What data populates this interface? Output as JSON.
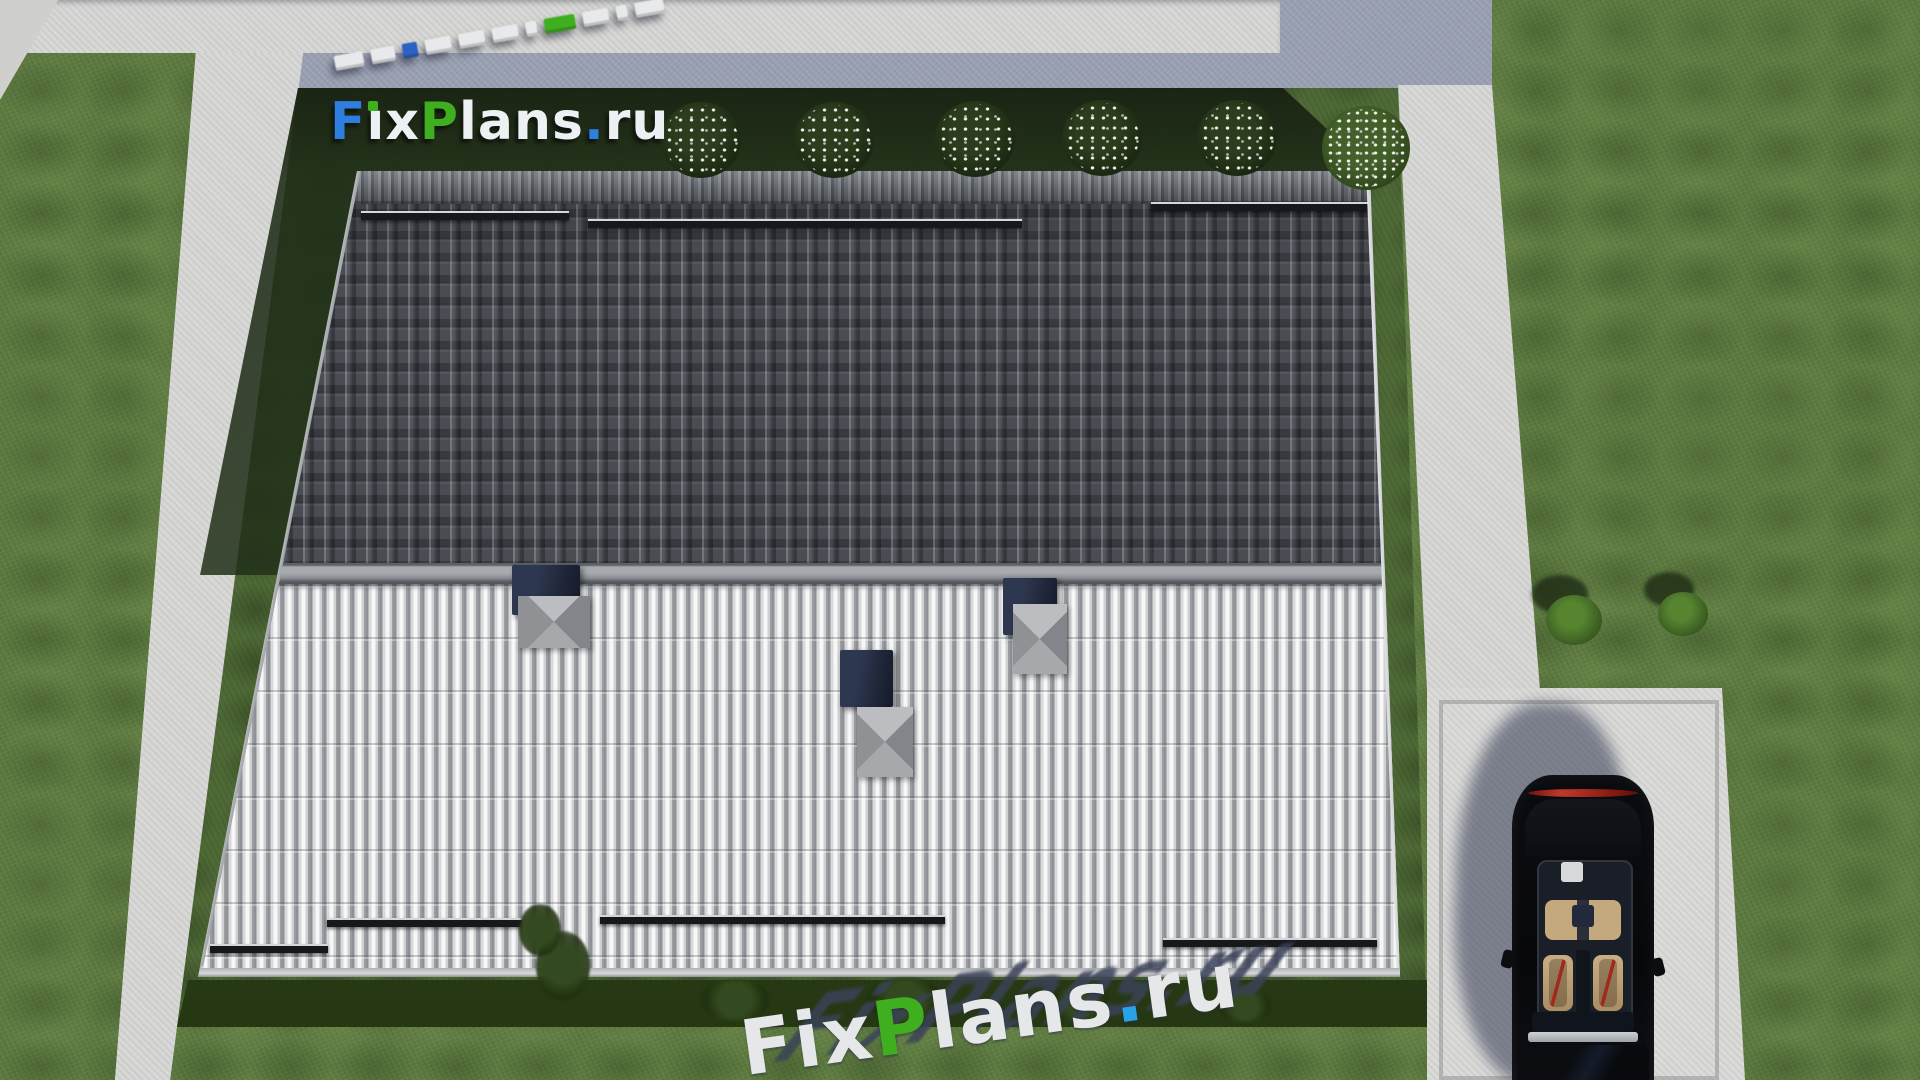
{
  "brand": {
    "name": "FixPlans.ru"
  },
  "logo": {
    "text": "FixPlans.ru",
    "letters": [
      {
        "ch": "F",
        "color": "#2e7ee0"
      },
      {
        "ch": "i",
        "color": "#eef1f3",
        "dot": "#3fae1f"
      },
      {
        "ch": "x",
        "color": "#eef1f3"
      },
      {
        "ch": "P",
        "color": "#3fae1f"
      },
      {
        "ch": "l",
        "color": "#eef1f3"
      },
      {
        "ch": "a",
        "color": "#eef1f3"
      },
      {
        "ch": "n",
        "color": "#eef1f3"
      },
      {
        "ch": "s",
        "color": "#eef1f3"
      },
      {
        "ch": ".",
        "color": "#2e7ee0"
      },
      {
        "ch": "r",
        "color": "#eef1f3"
      },
      {
        "ch": "u",
        "color": "#eef1f3"
      }
    ]
  },
  "watermark_top": {
    "text": "FixPlans.ru",
    "note": "3D extruded logo seen from above, reversed (reads right-to-left), ascending to the right",
    "blocks": [
      {
        "w": 29,
        "color": "w"
      },
      {
        "w": 24,
        "color": "w"
      },
      {
        "w": 15,
        "color": "b"
      },
      {
        "w": 26,
        "color": "w"
      },
      {
        "w": 26,
        "color": "w"
      },
      {
        "w": 26,
        "color": "w"
      },
      {
        "w": 11,
        "color": "w"
      },
      {
        "w": 31,
        "color": "g"
      },
      {
        "w": 26,
        "color": "w"
      },
      {
        "w": 11,
        "color": "w"
      },
      {
        "w": 29,
        "color": "w"
      }
    ]
  },
  "watermark_bottom": {
    "text": "FixPlans.ru",
    "letters": [
      {
        "ch": "F",
        "color": "#e6e7e9"
      },
      {
        "ch": "i",
        "color": "#e6e7e9"
      },
      {
        "ch": "x",
        "color": "#e6e7e9"
      },
      {
        "ch": "P",
        "color": "#3fae1f"
      },
      {
        "ch": "l",
        "color": "#e6e7e9"
      },
      {
        "ch": "a",
        "color": "#e6e7e9"
      },
      {
        "ch": "n",
        "color": "#e6e7e9"
      },
      {
        "ch": "s",
        "color": "#e6e7e9"
      },
      {
        "ch": ".",
        "color": "#2aa2e8"
      },
      {
        "ch": "r",
        "color": "#e6e7e9"
      },
      {
        "ch": "u",
        "color": "#e6e7e9"
      }
    ]
  },
  "colors": {
    "grass": "#5d7a40",
    "plot": "#4f6a37",
    "hedge": "#1a2413",
    "path": "#d7d7d5",
    "path_shadow": "#9aa1b3",
    "roof_dark": "#45484e",
    "roof_light": "#c6c7c9",
    "ridge": "#8d9094",
    "chimney_navy": "#222938",
    "logo_blue": "#2e7ee0",
    "logo_green": "#3fae1f",
    "logo_white": "#eef1f3",
    "wm_shadow": "#3b4258",
    "wm_dot_blue": "#2aa2e8",
    "car_black": "#0a0b0e",
    "seat_tan": "#c4a87e",
    "taillight_red": "#c0392a"
  },
  "landscape": {
    "hedge_bushes": [
      {
        "x": 701,
        "y": 142,
        "r": 40
      },
      {
        "x": 834,
        "y": 142,
        "r": 40
      },
      {
        "x": 975,
        "y": 141,
        "r": 40
      },
      {
        "x": 1102,
        "y": 140,
        "r": 40
      },
      {
        "x": 1237,
        "y": 140,
        "r": 40
      },
      {
        "x": 1366,
        "y": 150,
        "r": 44,
        "light": true
      }
    ],
    "hedge_shrubs": [
      {
        "x": 563,
        "y": 966,
        "w": 54,
        "h": 70
      },
      {
        "x": 540,
        "y": 930,
        "w": 42,
        "h": 52
      },
      {
        "x": 735,
        "y": 1000,
        "w": 72,
        "h": 42
      },
      {
        "x": 905,
        "y": 1000,
        "w": 78,
        "h": 44
      },
      {
        "x": 1080,
        "y": 1002,
        "w": 62,
        "h": 38
      },
      {
        "x": 1245,
        "y": 1006,
        "w": 56,
        "h": 32
      }
    ],
    "lawn_bushes": [
      {
        "x": 1574,
        "y": 623,
        "r": 28
      },
      {
        "x": 1683,
        "y": 617,
        "r": 25
      }
    ]
  },
  "roof": {
    "snow_guards_upper": [
      {
        "x": 361,
        "y": 211,
        "w": 208
      },
      {
        "x": 588,
        "y": 219,
        "w": 434
      },
      {
        "x": 1151,
        "y": 202,
        "w": 230
      }
    ],
    "snow_guards_lower": [
      {
        "x": 210,
        "y": 944,
        "w": 118
      },
      {
        "x": 327,
        "y": 918,
        "w": 195
      },
      {
        "x": 600,
        "y": 915,
        "w": 345
      },
      {
        "x": 1163,
        "y": 938,
        "w": 214
      }
    ],
    "chimneys": [
      {
        "bx": 512,
        "by": 565,
        "bw": 68,
        "bh": 50,
        "cx": 518,
        "cy": 596,
        "cw": 72,
        "ch": 52
      },
      {
        "bx": 1003,
        "by": 578,
        "bw": 54,
        "bh": 57,
        "cx": 1013,
        "cy": 604,
        "cw": 54,
        "ch": 70
      },
      {
        "bx": 840,
        "by": 650,
        "bw": 53,
        "bh": 57,
        "cx": 857,
        "cy": 707,
        "cw": 56,
        "ch": 70
      }
    ]
  }
}
